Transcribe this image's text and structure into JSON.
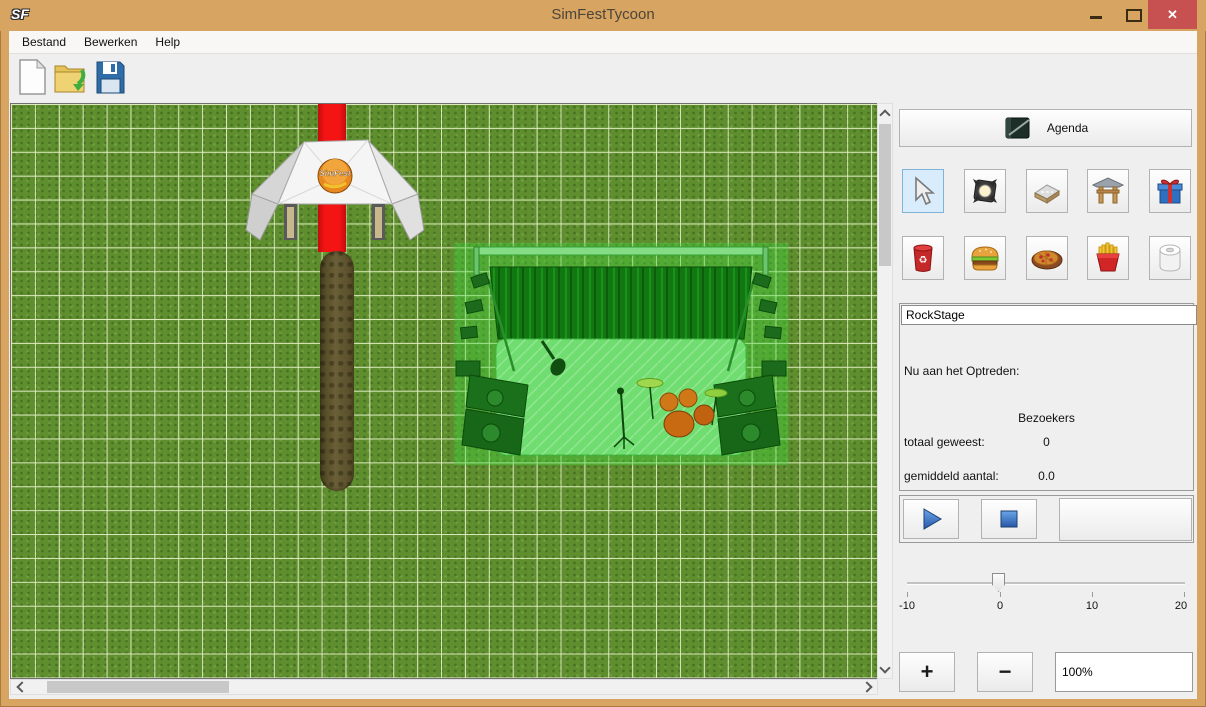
{
  "window": {
    "icon_text": "SF",
    "title": "SimFestTycoon",
    "controls": {
      "minimize": "",
      "maximize": "",
      "close": "✕"
    }
  },
  "menu": {
    "items": [
      {
        "label": "Bestand"
      },
      {
        "label": "Bewerken"
      },
      {
        "label": "Help"
      }
    ]
  },
  "toolbar": {
    "icons": [
      {
        "name": "new-document-icon"
      },
      {
        "name": "open-folder-icon"
      },
      {
        "name": "save-floppy-icon"
      }
    ]
  },
  "canvas": {
    "tent_logo": "SimFest",
    "objects": [
      "entrance-tent",
      "red-carpet",
      "dirt-path",
      "stage-selected"
    ]
  },
  "sidebar": {
    "agenda": {
      "label": "Agenda",
      "icon": "agenda-notebook-icon"
    },
    "tools": {
      "selected": "select-cursor",
      "row1": [
        {
          "icon": "select-cursor-icon"
        },
        {
          "icon": "spotlight-icon"
        },
        {
          "icon": "road-tile-icon"
        },
        {
          "icon": "gate-icon"
        },
        {
          "icon": "gift-icon"
        }
      ],
      "row2": [
        {
          "icon": "trash-bin-icon"
        },
        {
          "icon": "hamburger-icon"
        },
        {
          "icon": "pizza-icon"
        },
        {
          "icon": "fries-icon"
        },
        {
          "icon": "toilet-paper-icon"
        }
      ]
    },
    "stage_name": {
      "value": "RockStage"
    },
    "now_performing_label": "Nu aan het Optreden:",
    "visitors": {
      "header": "Bezoekers",
      "total_label": "totaal geweest:",
      "total_value": "0",
      "average_label": "gemiddeld aantal:",
      "average_value": "0.0"
    },
    "playback": {
      "play_icon": "play-icon",
      "stop_icon": "stop-icon"
    },
    "slider": {
      "labels": [
        "-10",
        "0",
        "10",
        "20"
      ],
      "value": 0,
      "min": -10,
      "max": 20
    },
    "zoom": {
      "plus": "+",
      "minus": "−",
      "value": "100%"
    }
  },
  "colors": {
    "titlebar": "#d7a462",
    "close_button": "#c75050",
    "selection_tint": "#3ed43e",
    "tool_selected_bg": "#d9ecfb",
    "grass": "#5e8e2e"
  }
}
